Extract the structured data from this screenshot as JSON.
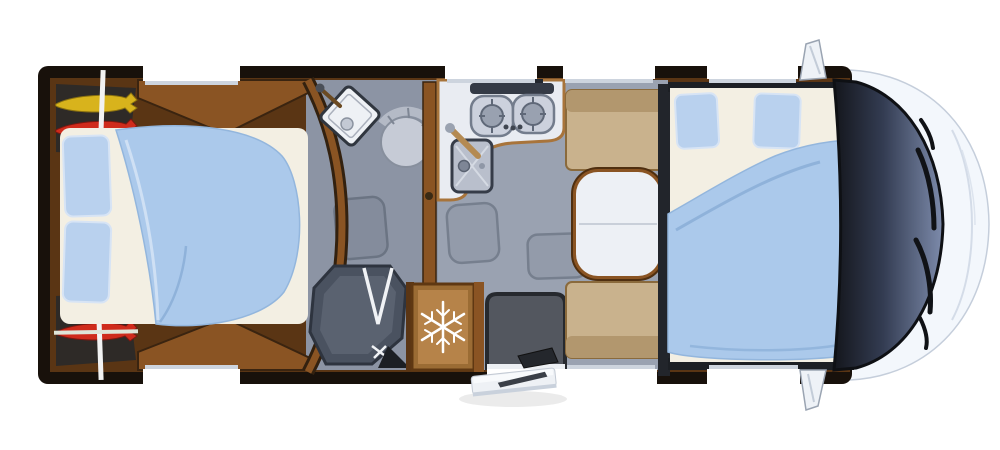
{
  "meta": {
    "description": "Top-down 3D floor plan rendering of a motorhome / RV interior",
    "canvas": {
      "width": 1000,
      "height": 450
    }
  },
  "icons": {
    "snowflake_icon": "❄",
    "snowflake_meaning": "refrigerator"
  },
  "areas": [
    "rear garage storage (kayaks and gear)",
    "rear island double bed",
    "bathroom with corner shower basin and toilet",
    "separate shower cubicle with folding door",
    "kitchen with two-burner hob and sink",
    "refrigerator",
    "entrance door with mat and exterior step",
    "dinette with two facing benches and table",
    "drop-down double bed over cab",
    "driver cab with windshield, wipers, hood and side mirrors"
  ],
  "colors": {
    "page_bg": "#ffffff",
    "wall_dark": "#18110b",
    "wood": "#8a5423",
    "wood_dark": "#5a3514",
    "wood_light": "#b68349",
    "floor": "#9aa2b1",
    "floor_bath": "#8c94a4",
    "mattress": "#f3efe3",
    "duvet": "#abc9eb",
    "duvet_fold": "#8fb2da",
    "pillow": "#b9d1ee",
    "bench": "#c9b28d",
    "bench_back": "#b2976e",
    "table_top": "#edf0f5",
    "counter": "#e9ecf2",
    "fixture": "#c6cbd6",
    "backsplash": "#343a46",
    "burner": "#99a1b0",
    "mat": "#53575f",
    "shower_tray": "#4a5260",
    "storage_bg": "#2e2a27",
    "kayak_yellow": "#d8b31c",
    "kayak_red": "#cf2b1c",
    "gear_blue": "#7d9fc6",
    "pole_white": "#f2f2f2",
    "window_white": "#ffffff",
    "sill": "#cdd4de",
    "windshield_dark": "#333c52",
    "windshield_light": "#7d8bab",
    "hood": "#f3f7fc",
    "hood_line": "#c9d3e0",
    "mirror": "#eef2f7",
    "step": "#eef1f5",
    "snowflake": "#ffffff"
  }
}
